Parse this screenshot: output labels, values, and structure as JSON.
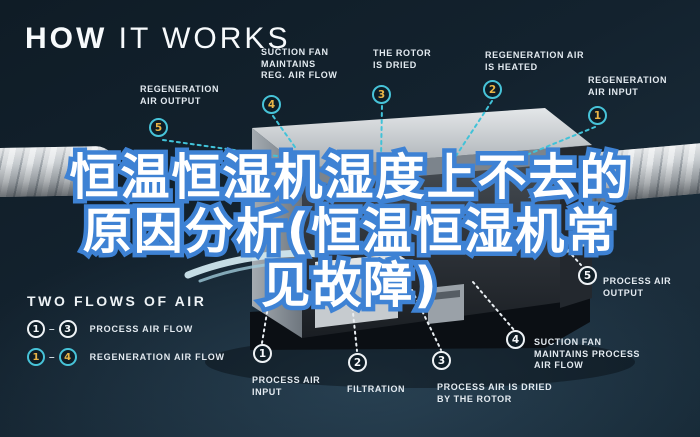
{
  "header": {
    "title_bold": "HOW",
    "title_light": " IT WORKS"
  },
  "overlay": {
    "line1": "恒温恒湿机湿度上不去的",
    "line2": "原因分析(恒温恒湿机常",
    "line3": "见故障)"
  },
  "callouts": {
    "regen_output": {
      "num": "5",
      "label": "REGENERATION\nAIR OUTPUT"
    },
    "suction_fan_reg": {
      "num": "4",
      "label": "SUCTION FAN\nMAINTAINS\nREG. AIR FLOW"
    },
    "rotor_dried": {
      "num": "3",
      "label": "THE ROTOR\nIS DRIED"
    },
    "regen_heated": {
      "num": "2",
      "label": "REGENERATION AIR\nIS HEATED"
    },
    "regen_input": {
      "num": "1",
      "label": "REGENERATION\nAIR INPUT"
    },
    "process_output": {
      "num": "5",
      "label": "PROCESS AIR\nOUTPUT"
    },
    "suction_fan_process": {
      "num": "4",
      "label": "SUCTION FAN\nMAINTAINS PROCESS\nAIR FLOW"
    },
    "process_dried": {
      "num": "3",
      "label": "PROCESS AIR IS DRIED\nBY THE ROTOR"
    },
    "filtration": {
      "num": "2",
      "label": "FILTRATION"
    },
    "process_input": {
      "num": "1",
      "label": "PROCESS AIR\nINPUT"
    }
  },
  "legend": {
    "title": "TWO FLOWS OF AIR",
    "rows": [
      {
        "from": "1",
        "dash": "–",
        "to": "3",
        "label": "PROCESS AIR FLOW"
      },
      {
        "from": "1",
        "dash": "–",
        "to": "4",
        "label": "REGENERATION AIR FLOW"
      }
    ]
  },
  "colors": {
    "background": "#13222e",
    "regen_teal": "#47c3d8",
    "badge_gold": "#e9b546",
    "process_white": "#eef2f5",
    "headline_outline_blue": "#3e82d4",
    "headline_fill": "#ffffff"
  }
}
